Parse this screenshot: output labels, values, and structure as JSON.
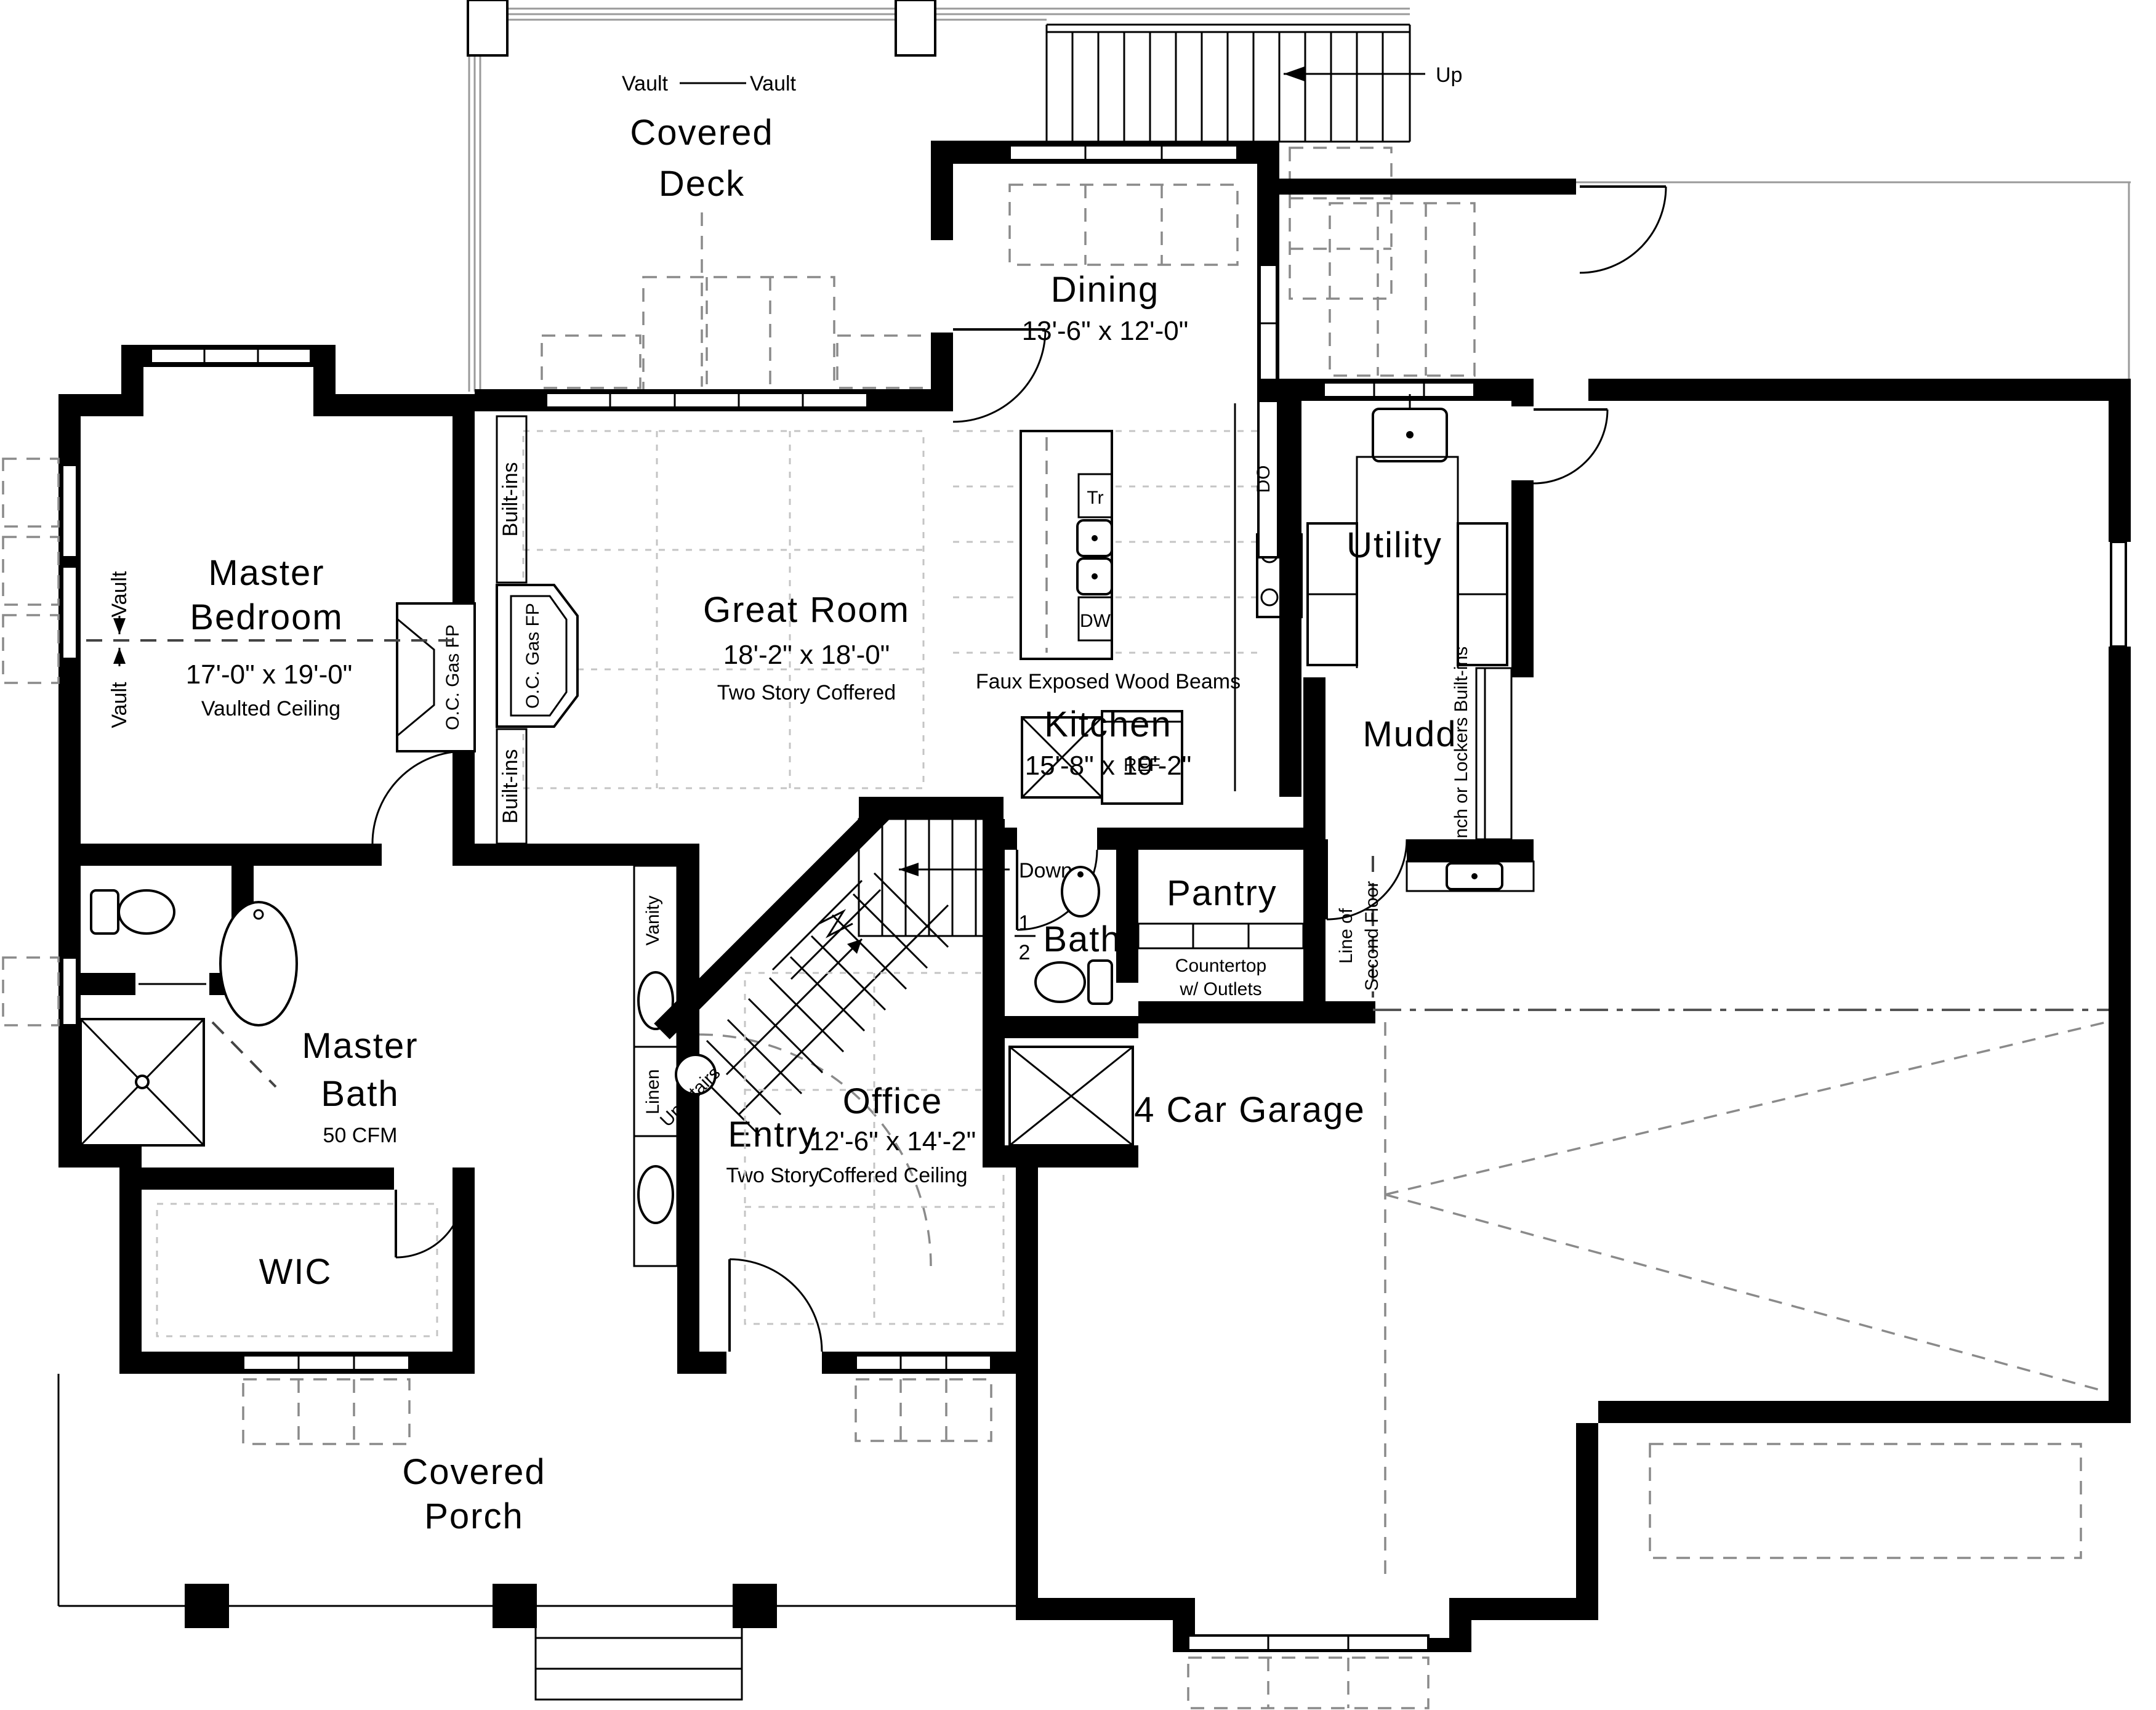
{
  "plan": {
    "rooms": {
      "covered_deck": {
        "line1": "Covered",
        "line2": "Deck"
      },
      "dining": {
        "name": "Dining",
        "dims": "13'-6\" x 12'-0\""
      },
      "master_bedroom": {
        "line1": "Master",
        "line2": "Bedroom",
        "dims": "17'-0\" x 19'-0\"",
        "note": "Vaulted Ceiling"
      },
      "great_room": {
        "name": "Great Room",
        "dims": "18'-2\" x 18'-0\"",
        "note": "Two Story Coffered"
      },
      "utility": {
        "name": "Utility"
      },
      "kitchen": {
        "name": "Kitchen",
        "dims": "15'-8\" x 19'-2\""
      },
      "mudd": {
        "name": "Mudd"
      },
      "master_bath": {
        "line1": "Master",
        "line2": "Bath",
        "note": "50 CFM"
      },
      "half_bath": {
        "numerator": "1",
        "denominator": "2",
        "name": "Bath"
      },
      "pantry": {
        "name": "Pantry"
      },
      "office": {
        "name": "Office",
        "dims": "12'-6\" x 14'-2\"",
        "note": "Coffered Ceiling"
      },
      "entry": {
        "name": "Entry",
        "note": "Two Story"
      },
      "wic": {
        "name": "WIC"
      },
      "covered_porch": {
        "line1": "Covered",
        "line2": "Porch"
      },
      "garage": {
        "name": "4 Car Garage"
      }
    },
    "annotations": {
      "vault": "Vault",
      "up": "Up",
      "up_stairs": "Up Stairs",
      "down": "Down",
      "built_ins": "Built-ins",
      "oc_gas_fp": "O.C. Gas FP",
      "faux_beams": "Faux Exposed Wood Beams",
      "tr": "Tr",
      "dw": "DW",
      "ref": "REF",
      "do": "DO",
      "bench": "Bench or Lockers Built-ins",
      "countertop_line1": "Countertop",
      "countertop_line2": "w/ Outlets",
      "second_floor_line1": "Line of",
      "second_floor_line2": "Second Floor",
      "vanity": "Vanity",
      "linen": "Linen"
    },
    "colors": {
      "walls": "#000000",
      "dashed": "#8a8a8a",
      "grid": "#c4c4c4"
    }
  }
}
